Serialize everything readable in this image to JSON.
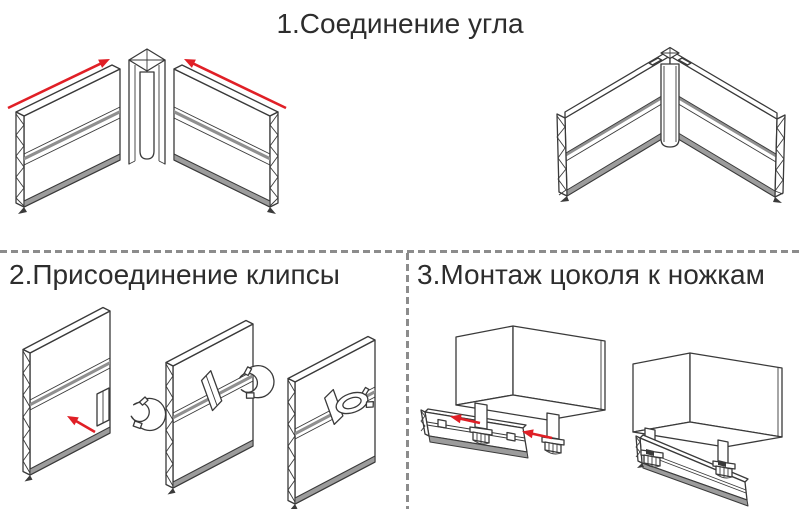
{
  "sections": [
    {
      "number": "1",
      "title": "1.Соединение угла"
    },
    {
      "number": "2",
      "title": "2.Присоединение клипсы"
    },
    {
      "number": "3",
      "title": "3.Монтаж цоколя к ножкам"
    }
  ],
  "colors": {
    "line_dark": "#3a3a3a",
    "arrow_red": "#e01f26",
    "divider_gray": "#8c8c8c",
    "shade_gray": "#9c9c9c",
    "groove_gray": "#8f8f8f",
    "text": "#2d2d2d",
    "background": "#ffffff"
  }
}
